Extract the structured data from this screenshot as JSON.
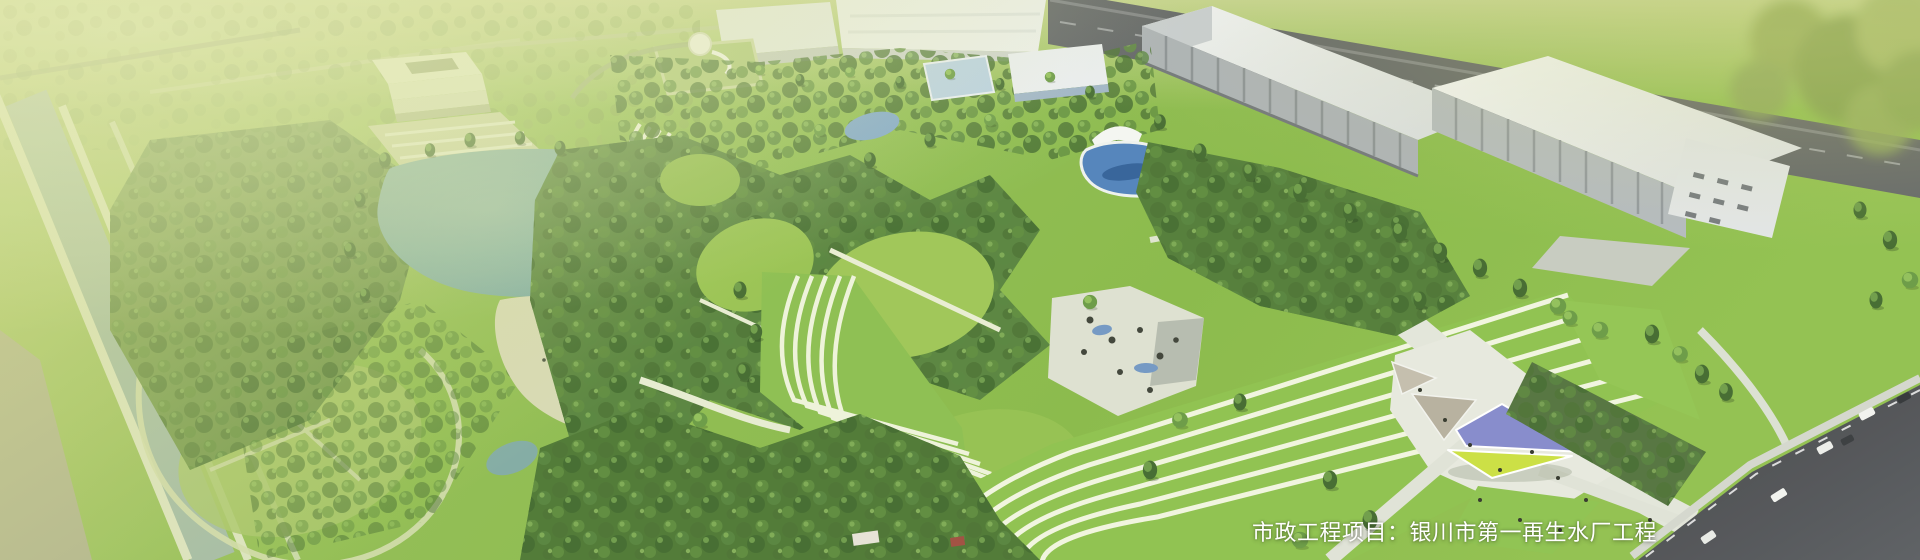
{
  "banner": {
    "caption": "市政工程项目：银川市第一再生水厂工程",
    "caption_color": "#ffffff"
  },
  "scene": {
    "type": "aerial-architectural-rendering",
    "features": [
      "office-building-with-parking",
      "central-lake-with-beach",
      "terraced-contour-lawns",
      "treatment-pools",
      "industrial-plant-buildings",
      "triangular-canopy-plaza",
      "perimeter-road-with-cars",
      "riverside-greenway"
    ]
  },
  "palette": {
    "wash_overlay": "#d8e08e",
    "grass_bright": "#8fc04a",
    "grass_lime": "#9ccb3f",
    "grass_soft": "#a8c468",
    "forest_dark": "#2c4f21",
    "forest_mid": "#4e7c33",
    "forest_light": "#7fb046",
    "lake_water": "#7fada3",
    "pool_water": "#4d80ba",
    "building_roof": "#eef0f2",
    "building_face": "#aab0b6",
    "road_dark": "#4a4d51",
    "path_white": "#f1f5df",
    "beach_sand": "#d6d9b2",
    "canopy_blue": "#8287cb",
    "canopy_yellow": "#cadf3e",
    "canopy_tan": "#bdb7a5"
  }
}
